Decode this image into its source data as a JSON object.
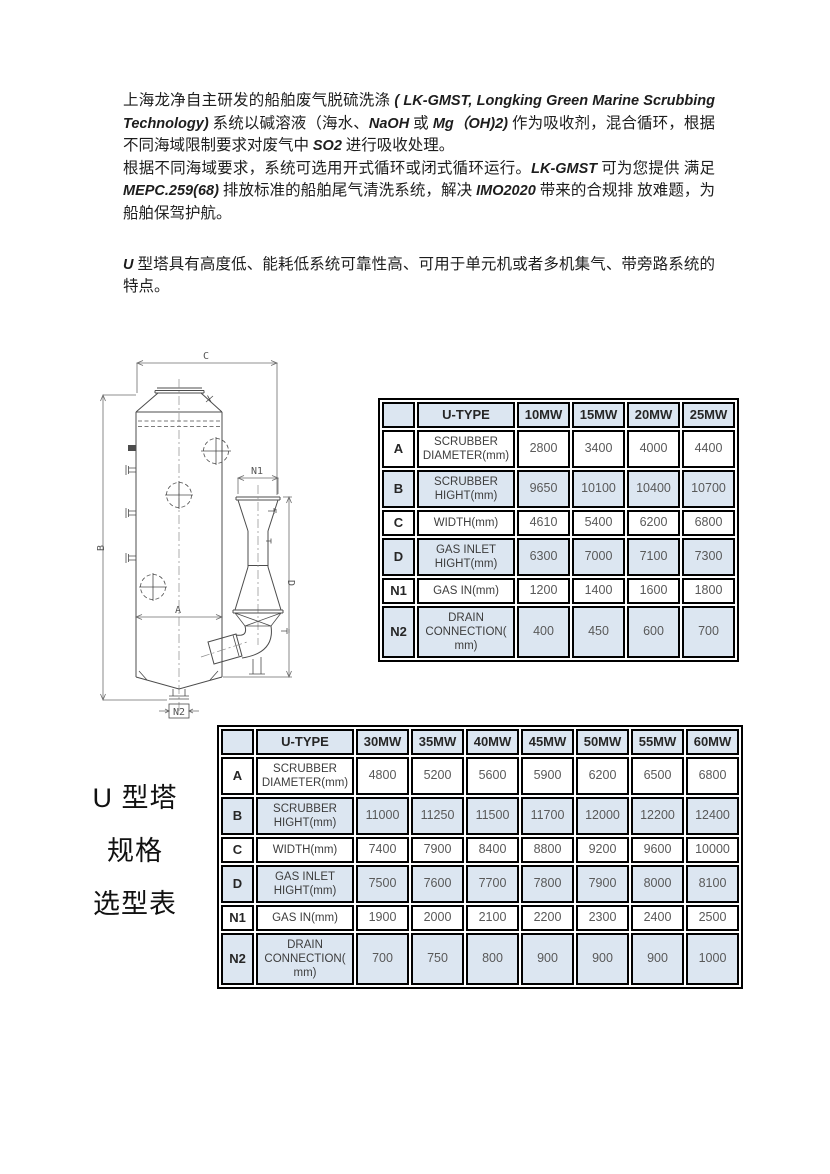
{
  "paragraphs": {
    "p1": [
      {
        "t": "上海龙净自主研发的船舶废气脱硫洗涤 ",
        "i": false
      },
      {
        "t": "( LK-GMST, Longking Green Marine Scrubbing Technology)",
        "i": true
      },
      {
        "t": " 系统以碱溶液（海水、",
        "i": false
      },
      {
        "t": "NaOH",
        "i": true
      },
      {
        "t": " 或 ",
        "i": false
      },
      {
        "t": "Mg（OH)2)",
        "i": true
      },
      {
        "t": " 作为吸收剂，混合循环，根据不同海域限制要求对废气中 ",
        "i": false
      },
      {
        "t": "SO2",
        "i": true
      },
      {
        "t": " 进行吸收处理。",
        "i": false
      }
    ],
    "p2": [
      {
        "t": "根据不同海域要求，系统可选用开式循环或闭式循环运行。",
        "i": false
      },
      {
        "t": "LK-GMST",
        "i": true
      },
      {
        "t": " 可为您提供 满足 ",
        "i": false
      },
      {
        "t": "MEPC.259(68)",
        "i": true
      },
      {
        "t": " 排放标准的船舶尾气清洗系统，解决 ",
        "i": false
      },
      {
        "t": "IMO2020",
        "i": true
      },
      {
        "t": " 带来的合规排 放难题，为船舶保驾护航。",
        "i": false
      }
    ],
    "p3": [
      {
        "t": "U",
        "i": true
      },
      {
        "t": " 型塔具有高度低、能耗低系统可靠性高、可用于单元机或者多机集气、带旁路系统的特点。",
        "i": false
      }
    ]
  },
  "diagram": {
    "labels": {
      "c": "C",
      "b": "B",
      "a": "A",
      "d": "D",
      "n1": "N1",
      "n2": "N2"
    }
  },
  "side_label": {
    "lines": [
      "U 型塔",
      "规格",
      "选型表"
    ]
  },
  "tables": [
    {
      "name": "u-type-selection-10-25mw",
      "header": [
        "",
        "U-TYPE",
        "10MW",
        "15MW",
        "20MW",
        "25MW"
      ],
      "rows": [
        {
          "key": "A",
          "label": "SCRUBBER DIAMETER(mm)",
          "values": [
            "2800",
            "3400",
            "4000",
            "4400"
          ],
          "shaded": false
        },
        {
          "key": "B",
          "label": "SCRUBBER HIGHT(mm)",
          "values": [
            "9650",
            "10100",
            "10400",
            "10700"
          ],
          "shaded": true
        },
        {
          "key": "C",
          "label": "WIDTH(mm)",
          "values": [
            "4610",
            "5400",
            "6200",
            "6800"
          ],
          "shaded": false
        },
        {
          "key": "D",
          "label": "GAS INLET HIGHT(mm)",
          "values": [
            "6300",
            "7000",
            "7100",
            "7300"
          ],
          "shaded": true
        },
        {
          "key": "N1",
          "label": "GAS IN(mm)",
          "values": [
            "1200",
            "1400",
            "1600",
            "1800"
          ],
          "shaded": false
        },
        {
          "key": "N2",
          "label": "DRAIN CONNECTION( mm)",
          "values": [
            "400",
            "450",
            "600",
            "700"
          ],
          "shaded": true
        }
      ]
    },
    {
      "name": "u-type-selection-30-60mw",
      "header": [
        "",
        "U-TYPE",
        "30MW",
        "35MW",
        "40MW",
        "45MW",
        "50MW",
        "55MW",
        "60MW"
      ],
      "rows": [
        {
          "key": "A",
          "label": "SCRUBBER DIAMETER(mm)",
          "values": [
            "4800",
            "5200",
            "5600",
            "5900",
            "6200",
            "6500",
            "6800"
          ],
          "shaded": false
        },
        {
          "key": "B",
          "label": "SCRUBBER HIGHT(mm)",
          "values": [
            "11000",
            "11250",
            "11500",
            "11700",
            "12000",
            "12200",
            "12400"
          ],
          "shaded": true
        },
        {
          "key": "C",
          "label": "WIDTH(mm)",
          "values": [
            "7400",
            "7900",
            "8400",
            "8800",
            "9200",
            "9600",
            "10000"
          ],
          "shaded": false
        },
        {
          "key": "D",
          "label": "GAS INLET HIGHT(mm)",
          "values": [
            "7500",
            "7600",
            "7700",
            "7800",
            "7900",
            "8000",
            "8100"
          ],
          "shaded": true
        },
        {
          "key": "N1",
          "label": "GAS IN(mm)",
          "values": [
            "1900",
            "2000",
            "2100",
            "2200",
            "2300",
            "2400",
            "2500"
          ],
          "shaded": false
        },
        {
          "key": "N2",
          "label": "DRAIN CONNECTION( mm)",
          "values": [
            "700",
            "750",
            "800",
            "900",
            "900",
            "900",
            "1000"
          ],
          "shaded": true
        }
      ]
    }
  ],
  "colors": {
    "table_shade": "#dce6f1",
    "table_border": "#000000",
    "value_text": "#595959",
    "header_text": "#262626"
  }
}
